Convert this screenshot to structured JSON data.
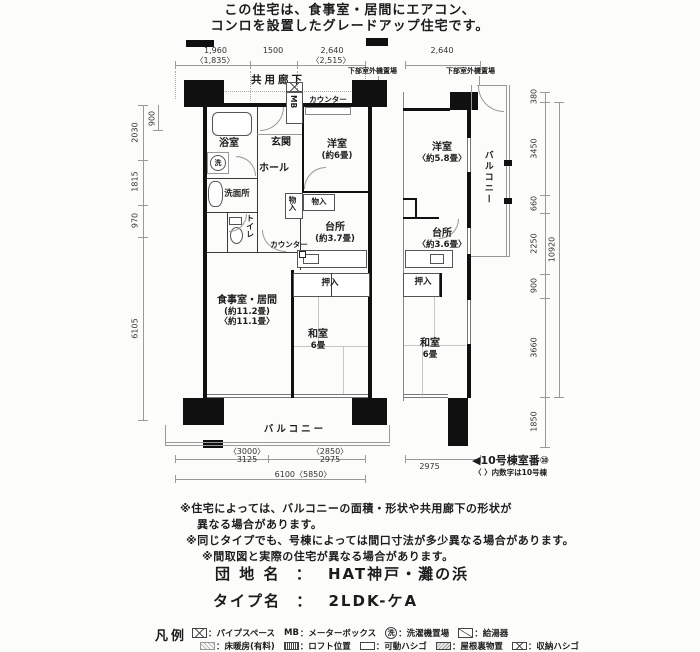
{
  "header": {
    "line1": "この住宅は、食事室・居間にエアコン、",
    "line2": "コンロを設置したグレードアップ住宅です。"
  },
  "plan": {
    "rooms": {
      "corridor": {
        "name": "共用廊下"
      },
      "outdoor_left": {
        "name": "下部室外機置場"
      },
      "outdoor_right": {
        "name": "下部室外機置場"
      },
      "mb": {
        "name": "MB"
      },
      "counter_top": {
        "name": "カウンター"
      },
      "counter_mid": {
        "name": "カウンター"
      },
      "bath": {
        "name": "浴室"
      },
      "entrance": {
        "name": "玄関"
      },
      "hall": {
        "name": "ホール"
      },
      "washroom": {
        "name": "洗面所"
      },
      "wash_machine": {
        "name": "洗"
      },
      "toilet": {
        "name": "トイレ"
      },
      "storage_a": {
        "name": "物入"
      },
      "storage_b": {
        "name": "物入"
      },
      "western_left": {
        "name": "洋室",
        "size": "(約6畳)"
      },
      "kitchen_left": {
        "name": "台所",
        "size": "(約3.7畳)"
      },
      "dining": {
        "name": "食事室・居間",
        "size1": "(約11.2畳)",
        "size2": "〈約11.1畳〉"
      },
      "oshiire_left": {
        "name": "押入"
      },
      "washitsu_left": {
        "name": "和室",
        "size": "6畳"
      },
      "balcony_bottom": {
        "name": "バルコニー"
      },
      "western_right": {
        "name": "洋室",
        "size": "〈約5.8畳〉"
      },
      "kitchen_right": {
        "name": "台所",
        "size": "〈約3.6畳〉"
      },
      "oshiire_right": {
        "name": "押入"
      },
      "washitsu_right": {
        "name": "和室",
        "size": "6畳"
      },
      "balcony_right": {
        "name": "バルコニー"
      }
    },
    "dims": {
      "top": [
        "1,960",
        "〈1,835〉",
        "1500",
        "2,640",
        "〈2,515〉",
        "2,640"
      ],
      "left": [
        "900",
        "2030",
        "1815",
        "970",
        "6105"
      ],
      "right": [
        "380",
        "3450",
        "660",
        "2250",
        "900",
        "3660",
        "1850"
      ],
      "right_total": "10920",
      "bottom": [
        "〈3000〉",
        "3125",
        "〈2850〉",
        "2975",
        "6100〈5850〉",
        "2975"
      ]
    },
    "annotations": {
      "room_number": "◀10号棟室番⑩",
      "kakko_note": "〈 〉内数字は10号棟"
    }
  },
  "notes": [
    "※住宅によっては、バルコニーの面積・形状や共用廊下の形状が",
    "異なる場合があります。",
    "※同じタイプでも、号棟によっては間口寸法が多少異なる場合があります。",
    "※間取図と実際の住宅が異なる場合があります。"
  ],
  "title_block": {
    "estate_label": "団 地 名",
    "sep": "：",
    "estate_value": "HAT神戸・灘の浜",
    "type_label": "タイプ名",
    "type_value": "2LDK-ケA"
  },
  "legend": {
    "title": "凡例",
    "row1": [
      {
        "symbol_text": "",
        "label": "：パイプスペース"
      },
      {
        "symbol_text": "MB",
        "label": "：メーターボックス"
      },
      {
        "symbol_text": "洗",
        "label": "：洗濯機置場"
      },
      {
        "symbol_text": "",
        "label": "：給湯器"
      }
    ],
    "row2": [
      {
        "label": "：床暖房(有料)"
      },
      {
        "label": "：ロフト位置"
      },
      {
        "label": "：可動ハシゴ"
      },
      {
        "label": "：屋根裏物置"
      },
      {
        "label": "：収納ハシゴ"
      }
    ]
  }
}
